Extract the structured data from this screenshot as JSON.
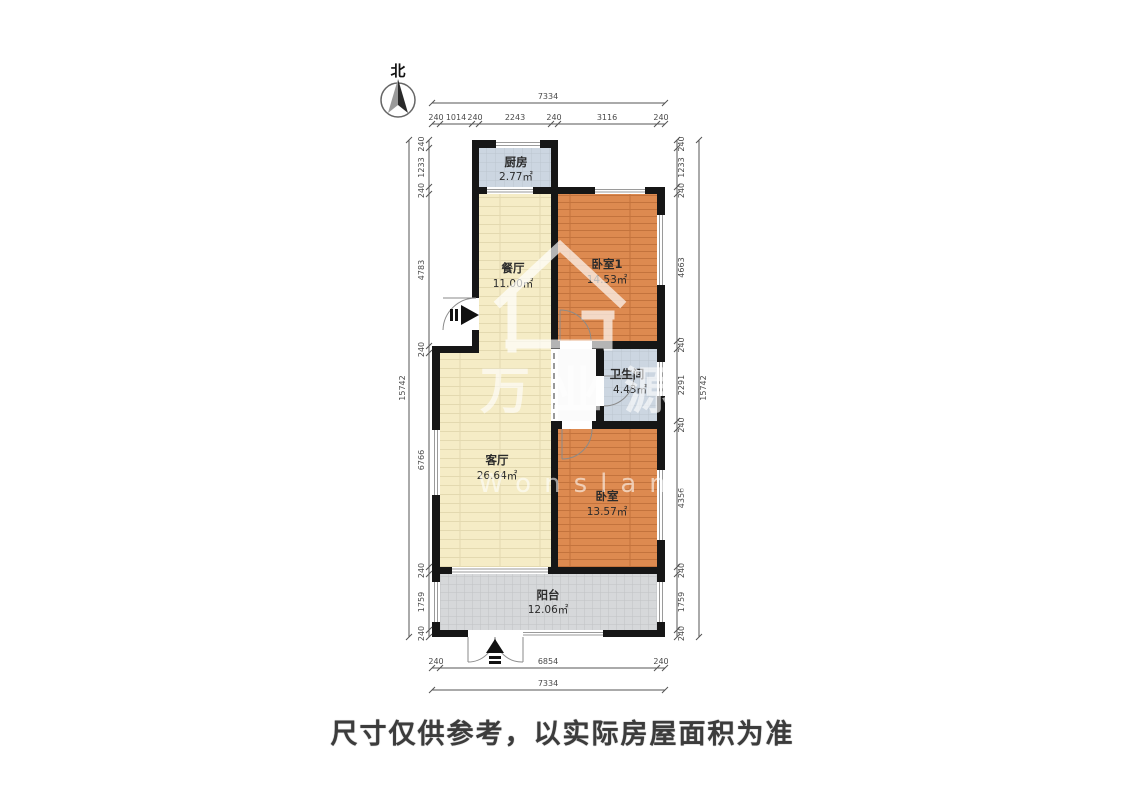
{
  "meta": {
    "north_label": "北",
    "caption": "尺寸仅供参考，以实际房屋面积为准"
  },
  "watermark": {
    "name_cn": "万业源",
    "name_en": "Wonsland"
  },
  "rooms": {
    "kitchen": {
      "name": "厨房",
      "area": "2.77㎡"
    },
    "dining": {
      "name": "餐厅",
      "area": "11.00㎡"
    },
    "bedroom1": {
      "name": "卧室1",
      "area": "14.53㎡"
    },
    "bathroom": {
      "name": "卫生间",
      "area": "4.43㎡"
    },
    "living": {
      "name": "客厅",
      "area": "26.64㎡"
    },
    "bedroom2": {
      "name": "卧室",
      "area": "13.57㎡"
    },
    "balcony": {
      "name": "阳台",
      "area": "12.06㎡"
    }
  },
  "dims": {
    "top_total": "7334",
    "top_segments": [
      "240",
      "1014",
      "240",
      "2243",
      "240",
      "3116",
      "240"
    ],
    "bottom_segments": [
      "240",
      "6854",
      "240"
    ],
    "bottom_total": "7334",
    "left_total": "15742",
    "left_segments": [
      "240",
      "1233",
      "240",
      "4783",
      "240",
      "6766",
      "240",
      "1759",
      "240"
    ],
    "right_segments": [
      "240",
      "1233",
      "240",
      "4663",
      "240",
      "2291",
      "240",
      "4356",
      "240",
      "1759",
      "240"
    ],
    "right_total": "15742"
  },
  "colors": {
    "wall": "#161616",
    "kitchen": "#ccd6e1",
    "bathroom": "#ccd6e1",
    "dining": "#f5ecc6",
    "living": "#f5ecc6",
    "corridor": "#fbfbfb",
    "bedroom": "#dd8a50",
    "balcony": "#d6d8da",
    "dim_line": "#555555",
    "watermark": "#ffffff"
  }
}
